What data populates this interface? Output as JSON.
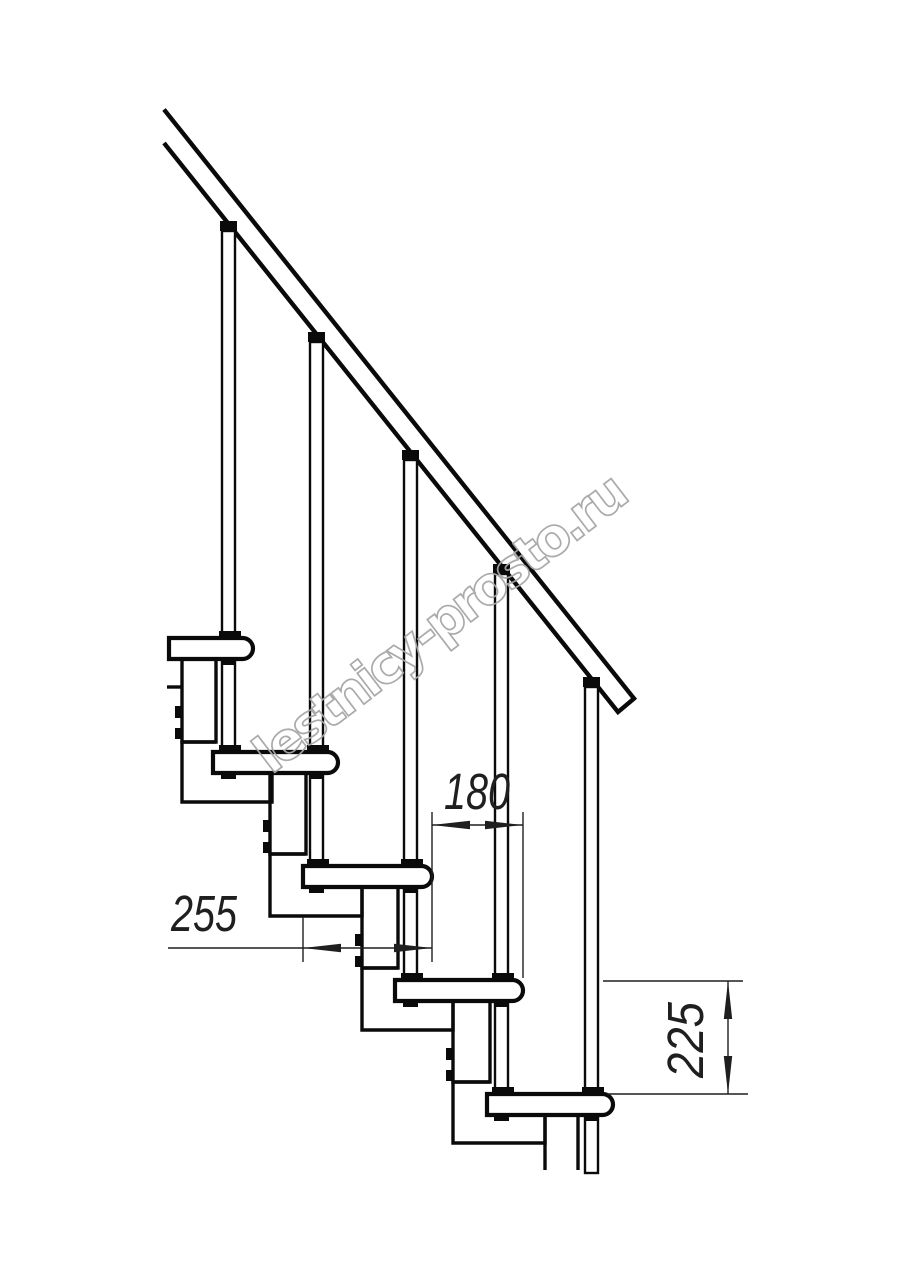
{
  "drawing": {
    "title": "modular-staircase-side-elevation",
    "background": "#ffffff",
    "line_color": "#0a0a0a",
    "dimension_color": "#1f1f1f",
    "dimensions": {
      "tread_length": "255",
      "step_run": "180",
      "step_rise": "225"
    },
    "watermark": {
      "text": "lestnicy-prosto.ru",
      "color": "#a6a6a6"
    }
  }
}
